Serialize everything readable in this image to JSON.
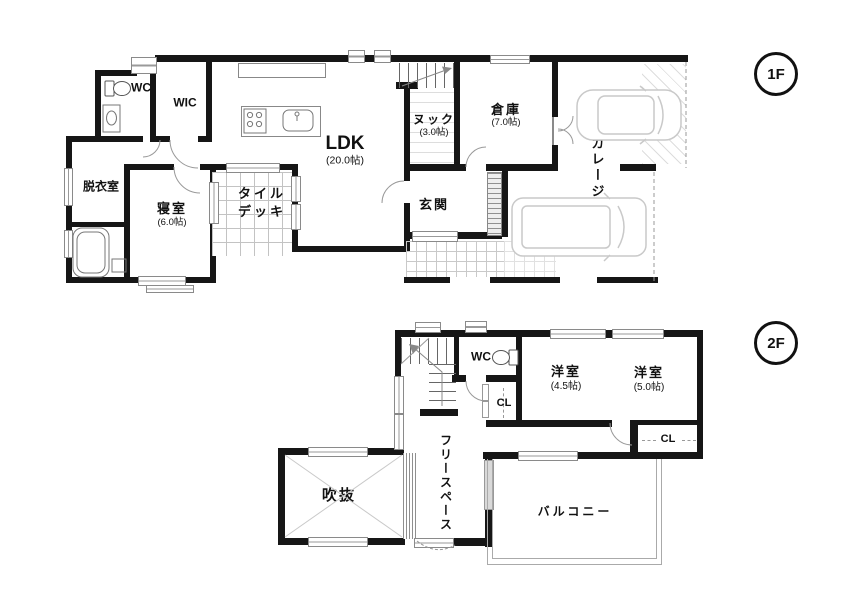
{
  "title": "house-floor-plan",
  "colors": {
    "wall": "#161616",
    "thin_line": "#8a8a8a",
    "grid": "#c3c3c3",
    "car_outline": "#c9c9c9"
  },
  "badges": {
    "f1": "1F",
    "f2": "2F"
  },
  "floor1": {
    "wc": "WC",
    "wic": "WIC",
    "dressing": "脱衣室",
    "bedroom": "寝室",
    "bedroom_size": "(6.0帖)",
    "bath": "UB",
    "deck_line1": "タイル",
    "deck_line2": "デッキ",
    "ldk": "LDK",
    "ldk_size": "(20.0帖)",
    "nook": "ヌック",
    "nook_size": "(3.0帖)",
    "storage": "倉庫",
    "storage_size": "(7.0帖)",
    "entrance": "玄関",
    "garage": "ガレージ"
  },
  "floor2": {
    "wc": "WC",
    "closet_upper": "CL",
    "closet_lower": "CL",
    "bedroom1": "洋室",
    "bedroom1_size": "(4.5帖)",
    "bedroom2": "洋室",
    "bedroom2_size": "(5.0帖)",
    "free_space": "フリースペース",
    "void": "吹抜",
    "balcony": "バルコニー"
  }
}
